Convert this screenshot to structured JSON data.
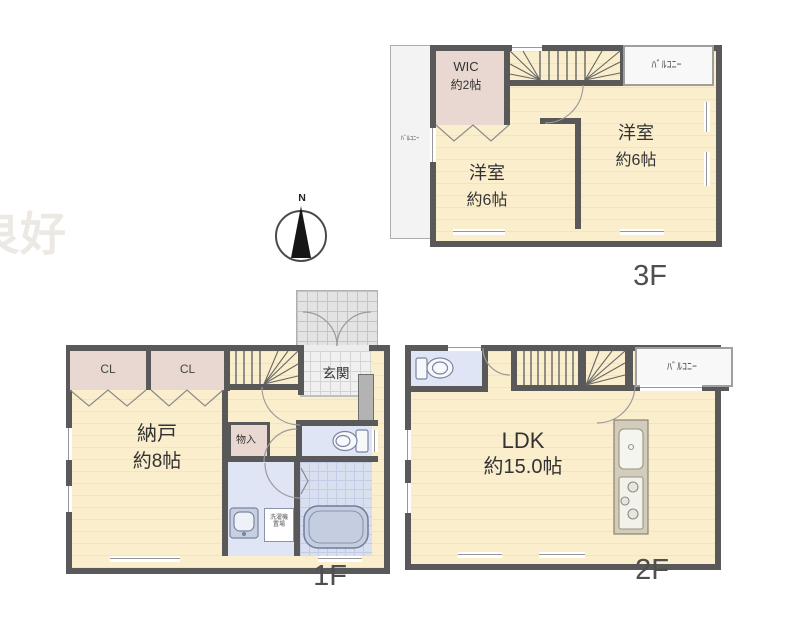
{
  "watermark": "良好",
  "compass": {
    "north_label": "N"
  },
  "floor3": {
    "floor_label": "3F",
    "balcony_left_label": "ﾊﾞﾙｺﾆｰ",
    "balcony_top_label": "ﾊﾞﾙｺﾆｰ",
    "wic_name": "WIC",
    "wic_size": "約2帖",
    "bedroom_right_name": "洋室",
    "bedroom_right_size": "約6帖",
    "bedroom_left_name": "洋室",
    "bedroom_left_size": "約6帖"
  },
  "floor1": {
    "floor_label": "1F",
    "closet1_label": "CL",
    "closet2_label": "CL",
    "entrance_label": "玄関",
    "storage_room_name": "納戸",
    "storage_room_size": "約8帖",
    "small_storage_label": "物入",
    "laundry_label": "洗濯機置場"
  },
  "floor2": {
    "floor_label": "2F",
    "balcony_label": "ﾊﾞﾙｺﾆｰ",
    "ldk_name": "LDK",
    "ldk_size": "約15.0帖"
  },
  "colors": {
    "wall": "#595959",
    "floor-cream": "#faeecd",
    "closet-pink": "#e9d7d1",
    "wet-blue": "#dfe5f4",
    "bath-tile": "#d8dfef",
    "balcony-bg": "#f8f8f8",
    "label-ink": "#333333",
    "floor-label-ink": "#4f4f4f"
  }
}
